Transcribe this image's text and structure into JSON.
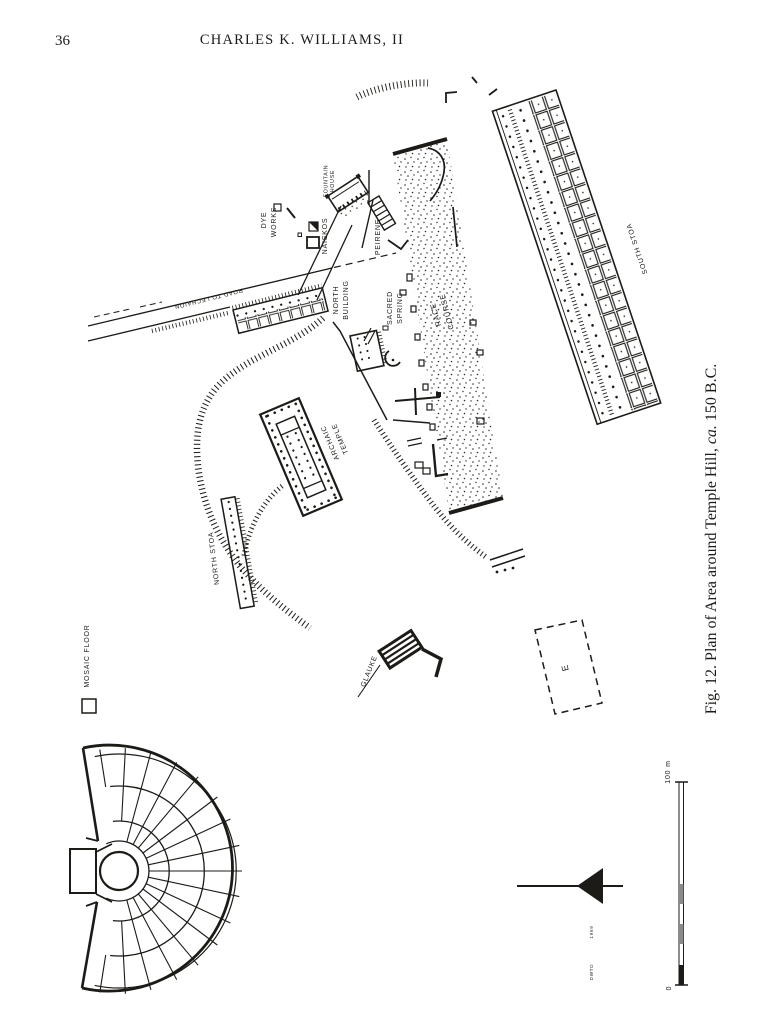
{
  "page": {
    "number": "36",
    "running_head": "CHARLES K. WILLIAMS, II",
    "caption": {
      "fig": "Fig. 12.",
      "text": "  Plan of Area around Temple Hill, ",
      "circa": "ca.",
      "date": " 150 ",
      "era": "B.C."
    }
  },
  "plan": {
    "labels": {
      "fountain_house": [
        "FOUNTAIN",
        "HOUSE"
      ],
      "dye_works": [
        "DYE",
        "WORKS"
      ],
      "naiskos": "NAISKOS",
      "peirene": "PEIRENE",
      "road_to_lechaion": "ROAD TO LECHAION",
      "north_building": [
        "NORTH",
        "BUILDING"
      ],
      "sacred_spring": [
        "SACRED",
        "SPRING"
      ],
      "race_course": [
        "RACE",
        "COURSE"
      ],
      "south_stoa": "SOUTH STOA",
      "archaic_temple": [
        "ARCHAIC",
        "TEMPLE"
      ],
      "north_stoa": "NORTH STOA",
      "mosaic_floor": "MOSAIC FLOOR",
      "glauke": "GLAUKE",
      "building_e": "E"
    },
    "scale_bar": {
      "top": "100 m",
      "bottom": "0"
    },
    "credits": {
      "year": "1969",
      "initials": "DWTD"
    },
    "ink_color": "#1d1b17",
    "paper_color": "#ffffff"
  }
}
